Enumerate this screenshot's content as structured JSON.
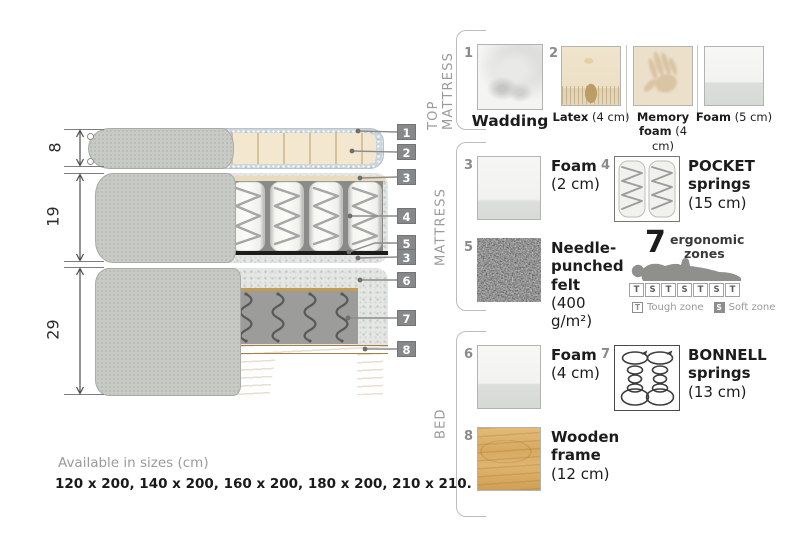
{
  "diagram": {
    "dims": [
      "8",
      "19",
      "29"
    ],
    "callouts": [
      "1",
      "2",
      "3",
      "4",
      "5",
      "3",
      "6",
      "7",
      "8"
    ]
  },
  "sections": {
    "top_mattress": {
      "label": "TOP MATTRESS",
      "items": [
        {
          "num": "1",
          "name": "Wadding",
          "detail": ""
        },
        {
          "num": "2",
          "name": "Latex",
          "detail": "(4 cm)"
        },
        {
          "num": "",
          "name": "Memory foam",
          "detail": "(4 cm)"
        },
        {
          "num": "",
          "name": "Foam",
          "detail": "(5 cm)"
        }
      ]
    },
    "mattress": {
      "label": "MATTRESS",
      "items": [
        {
          "num": "3",
          "name": "Foam",
          "detail": "(2 cm)"
        },
        {
          "num": "4",
          "name": "POCKET springs",
          "detail": "(15 cm)"
        },
        {
          "num": "5",
          "name": "Needle-punched felt",
          "detail": "(400 g/m²)"
        }
      ],
      "ergonomic": {
        "number": "7",
        "label_line1": "ergonomic",
        "label_line2": "zones",
        "zones": [
          "T",
          "S",
          "T",
          "S",
          "T",
          "S",
          "T"
        ],
        "t": "T",
        "s": "S",
        "tough": "Tough zone",
        "soft": "Soft zone"
      }
    },
    "bed": {
      "label": "BED",
      "items": [
        {
          "num": "6",
          "name": "Foam",
          "detail": "(4 cm)"
        },
        {
          "num": "7",
          "name": "BONNELL springs",
          "detail": "(13 cm)"
        },
        {
          "num": "8",
          "name": "Wooden frame",
          "detail": "(12 cm)"
        }
      ]
    }
  },
  "footer": {
    "title": "Available in sizes (cm)",
    "sizes": "120 x 200, 140 x 200, 160 x 200, 180 x 200, 210 x 210."
  },
  "colors": {
    "callout_box": "#87888a",
    "fabric_gray": "#c8cac5",
    "latex_cream": "#f3e7cf",
    "wood": "#d7ab5f",
    "muted_text": "#9b9b9b"
  }
}
